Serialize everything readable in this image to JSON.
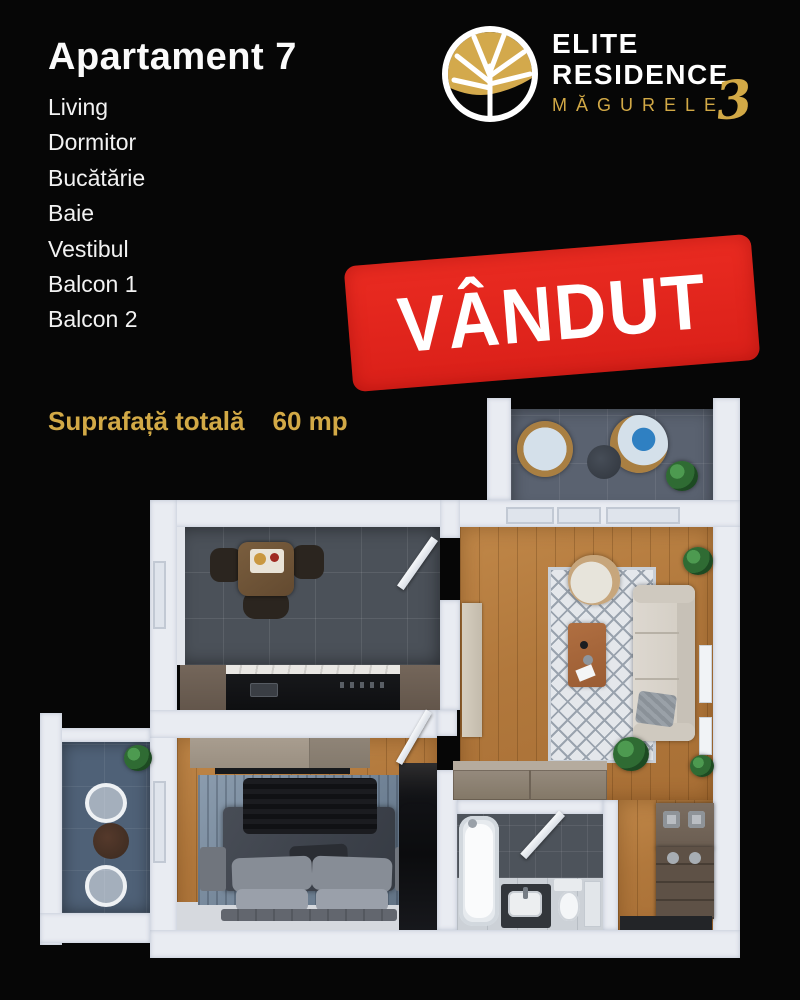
{
  "header": {
    "title": "Apartament 7",
    "rooms": [
      "Living",
      "Dormitor",
      "Bucătărie",
      "Baie",
      "Vestibul",
      "Balcon 1",
      "Balcon 2"
    ],
    "surface_label": "Suprafață totală",
    "surface_value": "60 mp"
  },
  "logo": {
    "line1": "ELITE",
    "line2": "RESIDENCE",
    "line3": "MĂGURELE",
    "number": "3"
  },
  "stamp": {
    "text": "VÂNDUT",
    "color": "#e4251f"
  },
  "colors": {
    "background": "#060606",
    "accent_gold": "#d2a946",
    "stamp_red": "#e4251f",
    "wall_white": "#e9ecf2",
    "wood_floor": "#b1783c",
    "kitchen_tile": "#4b5159",
    "balcony1_floor": "#5a6270",
    "balcony2_floor": "#4f6177",
    "bedroom_rug": "#6e8093",
    "living_rug": "#e4e7eb"
  }
}
